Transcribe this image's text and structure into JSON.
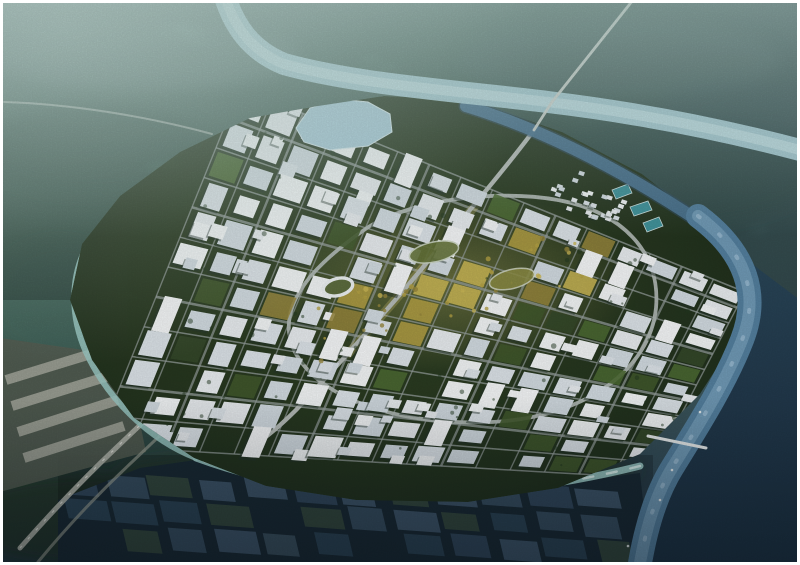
{
  "scene": {
    "kind": "aerial-architectural-rendering",
    "subject": "planned-city-masterplan",
    "atmosphere": "hazy-dusk"
  },
  "palette": {
    "frame": "#ffffff",
    "haze_top": "#9dbcb8",
    "haze_top_right": "#7b9da3",
    "haze_mid": "#6f958a",
    "land_green": "#4d7163",
    "land_dark": "#3a5a52",
    "bottom_dark": "#1c2f3f",
    "river_top": "#a9cdd7",
    "river_top_core": "#c6e2e7",
    "channel_ne": "#4a7390",
    "river_east": "#54809f",
    "river_east_core": "#7aa3bd",
    "water_dark": "#1d3344",
    "canal_light": "#9ccbc6",
    "canal_sparkle": "#e2f4f0",
    "city_ground": "#41582f",
    "city_ground_dark": "#233620",
    "road_main": "#b6bcb8",
    "road_bridge": "#cdd3cd",
    "street": "#97a09e",
    "ring_road": "#b0b8b4",
    "highway": "#b2b6ac",
    "building_shadow": "#24342a",
    "glow_gold": "#e4cf7e",
    "pool_teal": "#3f939b",
    "lake_blue": "#a8cbd9",
    "pond_base": "#203441",
    "warehouse_bg": "#535c51",
    "warehouse_strip": "#999d92",
    "haze_overlay": "#b9d4cf"
  },
  "generator": {
    "seed": 42,
    "city_grid": {
      "corners": {
        "p00": [
          240,
          88
        ],
        "p10": [
          745,
          292
        ],
        "p01": [
          96,
          446
        ],
        "p11": [
          648,
          478
        ]
      },
      "rows": 12,
      "cols": 16,
      "skip_probability": 0.12,
      "green_probability": 0.15,
      "tall_probability": 0.1,
      "second_block_probability": 0.55,
      "building_fills": [
        "#e9edf0",
        "#dde4e9",
        "#f3f6f7",
        "#d3dce2"
      ],
      "tall_fill": "#f6f8f9",
      "park_fills": [
        "#41592c",
        "#4d6a33",
        "#35492a"
      ],
      "gold_fills": [
        "#b5a245",
        "#cdb957",
        "#97873d"
      ],
      "spine": {
        "a": [
          308,
          332
        ],
        "b": [
          585,
          252
        ],
        "halfwidth": 40,
        "gold_probability": 0.45
      },
      "ne_green_zone": {
        "x_min": 500,
        "y_max": 250,
        "green_probability": 0.5
      },
      "se_green_zone": {
        "x_min": 560,
        "y_min": 330,
        "green_probability": 0.3
      },
      "tree_dots": 70,
      "tree_fill": "#22371f"
    },
    "ne_cluster": {
      "center": [
        588,
        196
      ],
      "rx": 40,
      "ry": 20,
      "rot_deg": 22,
      "count": 30
    },
    "ponds": {
      "cols": 12,
      "rows": 3,
      "origin": [
        78,
        486
      ],
      "col_step": [
        47,
        1.2
      ],
      "row_step": [
        9,
        26
      ],
      "half_cell": [
        20,
        10.5
      ],
      "fills": [
        "#4a6880",
        "#53728c",
        "#42607a",
        "#3a5a70",
        "#4f6c7e",
        "#46604e"
      ],
      "skip_probability": 0.08
    },
    "spine_dots": 40,
    "boats": [
      [
        660,
        500
      ],
      [
        628,
        546
      ],
      [
        700,
        412
      ],
      [
        672,
        470
      ]
    ]
  }
}
